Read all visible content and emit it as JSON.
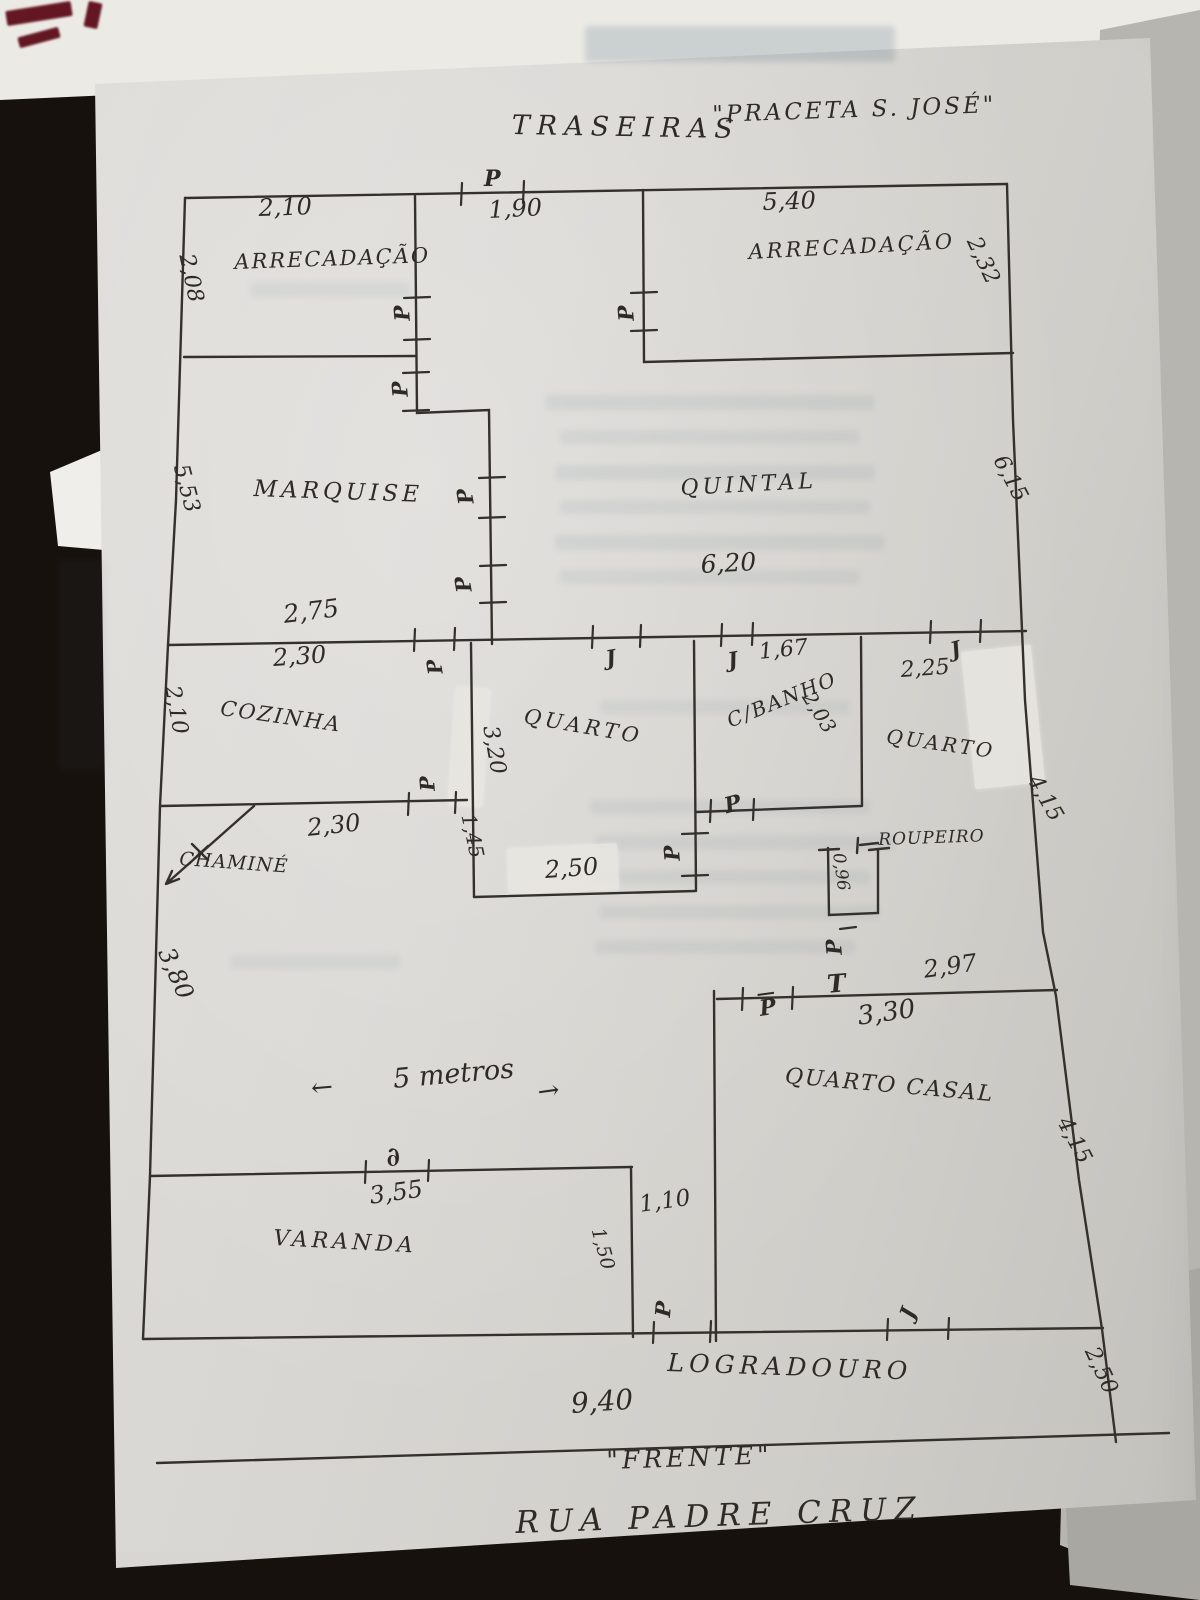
{
  "annotations": {
    "back_label": "TRASEIRAS",
    "back_square": "\"PRACETA S. JOSÉ\"",
    "front_label": "\"FRENTE\"",
    "street": "RUA PADRE CRUZ",
    "logradouro": "LOGRADOURO",
    "scale_arrow_left": "←",
    "scale_text": "5 metros",
    "scale_arrow_right": "→"
  },
  "rooms": {
    "arrecadacao_left": "ARRECADAÇÃO",
    "arrecadacao_right": "ARRECADAÇÃO",
    "marquise": "MARQUISE",
    "quintal": "QUINTAL",
    "cozinha": "COZINHA",
    "quarto_meio": "QUARTO",
    "banho": "C/BANHO",
    "quarto_dir": "QUARTO",
    "quarto_casal": "QUARTO CASAL",
    "varanda": "VARANDA",
    "chamine": "CHAMINÉ",
    "roupeiro": "ROUPEIRO"
  },
  "dims": {
    "arr_left_w": "2,10",
    "gate_w": "1,90",
    "arr_right_w": "5,40",
    "arr_left_h": "2,08",
    "arr_right_h": "2,32",
    "marquise_h": "5,53",
    "quintal_h": "6,15",
    "quintal_w": "6,20",
    "marquise_w": "2,75",
    "cozinha_w": "2,30",
    "cozinha_h": "2,10",
    "sala_w": "2,30",
    "sala_h": "3,80",
    "chamine_gap": "1,45",
    "quarto_h": "3,20",
    "quarto_w": "2,50",
    "banho_w": "1,67",
    "banho_h": "2,03",
    "quarto_dir_w": "2,25",
    "quarto_dir_h": "4,15",
    "roupeiro_h": "0,96",
    "hall_w": "2,97",
    "casal_w": "3,30",
    "casal_h": "4,15",
    "varanda_w": "3,55",
    "corredor_w": "1,10",
    "corredor_h": "1,50",
    "front_w": "9,40",
    "logradouro_h": "2,50"
  },
  "markers": {
    "door": "P",
    "window": "J",
    "tee": "T",
    "varanda_door": "∂"
  }
}
